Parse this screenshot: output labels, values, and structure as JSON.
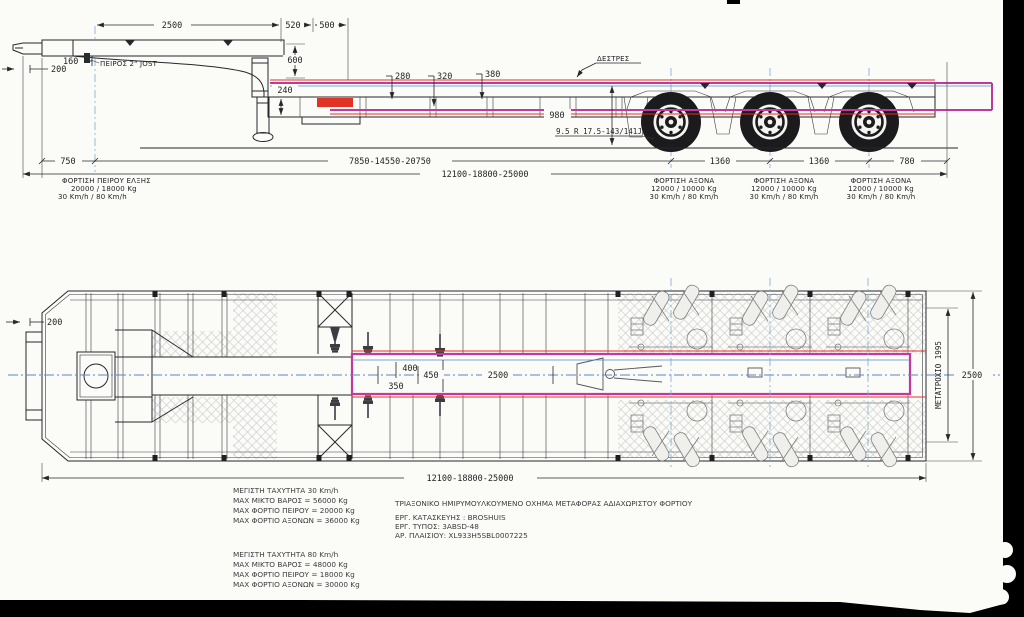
{
  "colors": {
    "highlight": "#c2399b",
    "red": "#e03226",
    "centerline": "#5b86c8",
    "hatch": "#cfcfcf",
    "ink": "#26272b"
  },
  "side": {
    "pin_label": "ΠΕΙΡΟΣ 2\" JOST",
    "lashing_label": "ΔΕΣΤΡΕΣ",
    "tire_label": "9.5 R 17.5-143/141J",
    "dims": {
      "d2500": "2500",
      "d520": "520",
      "d500": "500",
      "d600": "600",
      "d240": "240",
      "d160": "160",
      "d200": "200",
      "d280": "280",
      "d320": "320",
      "d380": "380",
      "d980": "980",
      "d750": "750",
      "d1360": "1360",
      "d780": "780",
      "pin_to_axle": "7850-14550-20750",
      "overall": "12100-18800-25000"
    },
    "pin_load": {
      "title": "ΦΟΡΤΙΣΗ ΠΕΙΡΟΥ ΕΛΞΗΣ",
      "loads": "20000 / 18000 Kg",
      "speeds": "30 Km/h / 80 Km/h"
    },
    "axle_load": {
      "title": "ΦΟΡΤΙΣΗ ΑΞΟΝΑ",
      "loads": "12000 / 10000 Kg",
      "speeds": "30 Km/h / 80 Km/h"
    }
  },
  "plan": {
    "dims": {
      "d200": "200",
      "d350": "350",
      "d400": "400",
      "d450": "450",
      "d2500c": "2500",
      "overall": "12100-18800-25000",
      "track": "ΜΕΤΑΤΡΟΧΙΟ 1995",
      "width": "2500"
    }
  },
  "blocks": {
    "specs30": [
      "ΜΕΓΙΣΤΗ ΤΑΧΥΤΗΤΑ 30  Km/h",
      "MAX  ΜΙΚΤΟ ΒΑΡΟΣ = 56000 Kg",
      "MAX ΦΟΡΤΙΟ ΠΕΙΡΟΥ = 20000 Kg",
      "MAX ΦΟΡΤΙΟ  ΑΞΟΝΩΝ = 36000 Kg"
    ],
    "specs80": [
      "ΜΕΓΙΣΤΗ ΤΑΧΥΤΗΤΑ 80  Km/h",
      "MAX  ΜΙΚΤΟ ΒΑΡΟΣ = 48000 Kg",
      "MAX ΦΟΡΤΙΟ ΠΕΙΡΟΥ = 18000 Kg",
      "MAX ΦΟΡΤΙΟ  ΑΞΟΝΩΝ = 30000 Kg"
    ],
    "vehicle": [
      "ΤΡΙΑΞΟΝΙΚΟ ΗΜΙΡΥΜΟΥΛΚΟΥΜΕΝΟ ΟΧΗΜΑ ΜΕΤΑΦΟΡΑΣ ΑΔΙΑΧΩΡΙΣΤΟΥ ΦΟΡΤΙΟΥ",
      "ΕΡΓ. ΚΑΤΑΣΚΕΥΗΣ : BROSHUIS",
      "ΕΡΓ. ΤΥΠΟΣ: 3ABSD-48",
      "ΑΡ. ΠΛΑΙΣΙΟΥ: XL933H5SBL0007225"
    ]
  }
}
